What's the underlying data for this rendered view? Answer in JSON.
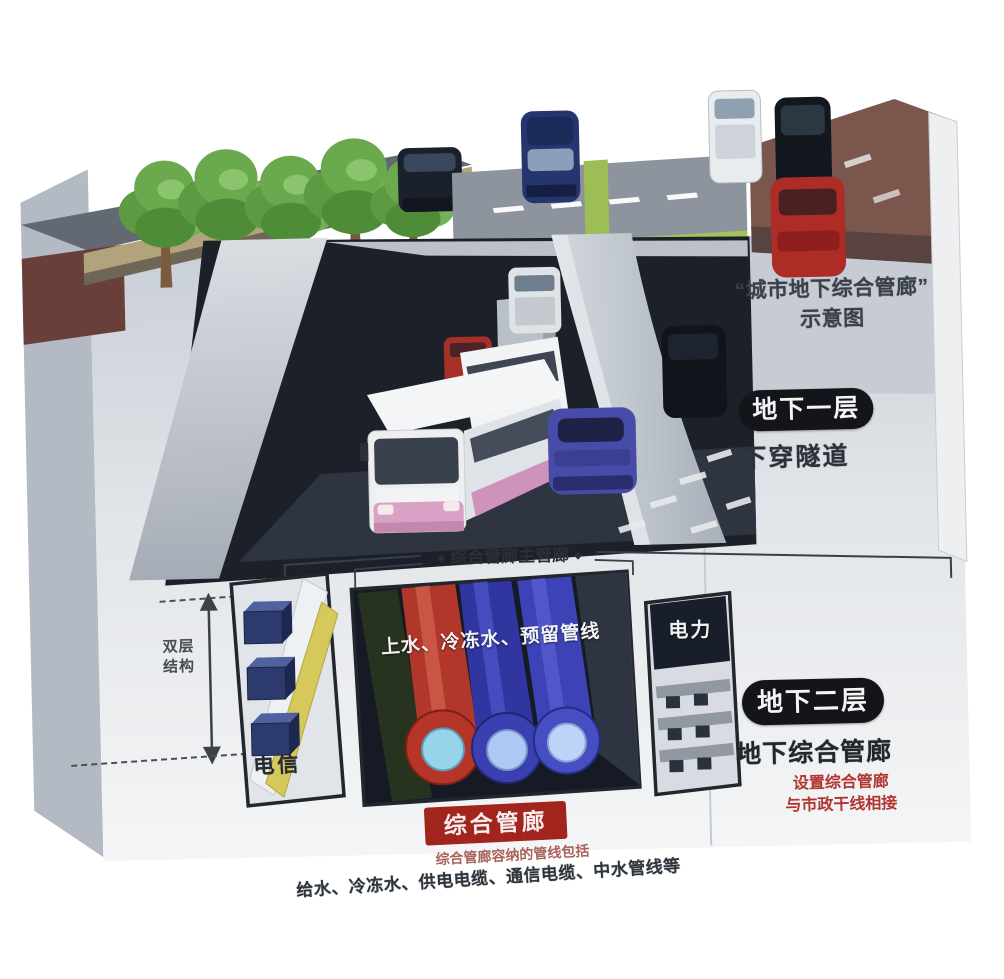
{
  "title": {
    "line1": "“城市地下综合管廊”",
    "line2": "示意图"
  },
  "level1": {
    "badge": "地下一层",
    "name": "下穿隧道"
  },
  "gallery": {
    "cap_left": "◆",
    "label": "综合管廊主管廊",
    "cap_right": "◆"
  },
  "measure": {
    "line1": "双层",
    "line2": "结构"
  },
  "compartments": {
    "telecom": "电信",
    "water": "上水、冷冻水、预留管线",
    "power": "电力"
  },
  "level2": {
    "badge": "地下二层",
    "name": "地下综合管廊",
    "note1": "设置综合管廊",
    "note2": "与市政干线相接"
  },
  "footer": {
    "badge": "综合管廊",
    "caption": "综合管廊容纳的管线包括",
    "pipelines": "给水、冷冻水、供电电缆、通信电缆、中水管线等"
  },
  "colors": {
    "badge_black": "#14151a",
    "badge_red": "#a1241d",
    "note_red": "#b23530",
    "text_dark": "#2b3037",
    "pipe_red": "#b0372a",
    "pipe_blue": "#3a40b2",
    "pipe_yellow": "#d5c95c",
    "median_green": "#a2c25b",
    "tunnel_dark": "#1c2029"
  }
}
